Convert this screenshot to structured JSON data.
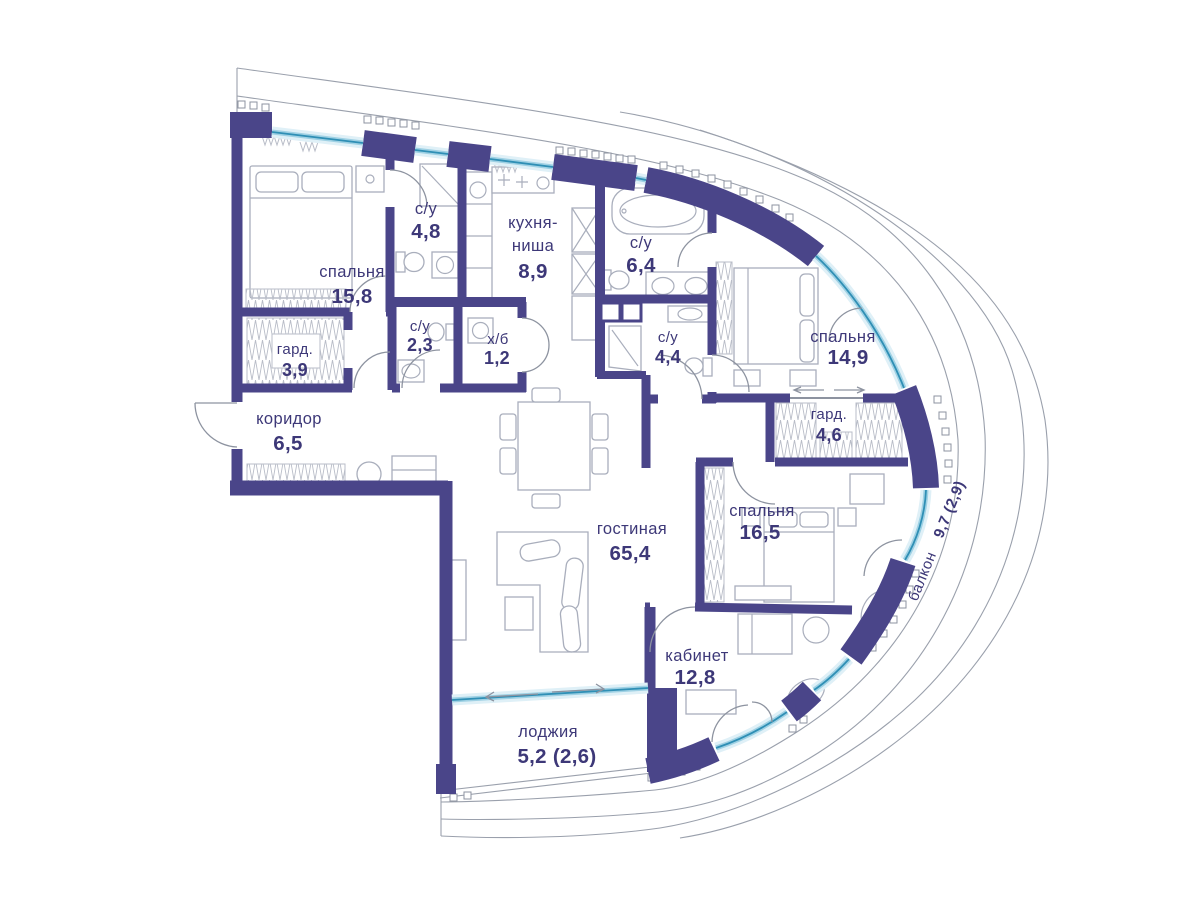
{
  "plan": {
    "type": "apartment-floor-plan",
    "language": "ru",
    "colors": {
      "walls": "#4a4589",
      "windows": "#3a9cc4",
      "labels": "#3d3878",
      "site_outline": "#9aa0ac",
      "furniture": "#a9aebc"
    },
    "rooms": {
      "bedroom1": {
        "name": "спальня",
        "area": "15,8"
      },
      "bath1": {
        "name": "с/у",
        "area": "4,8"
      },
      "kitchen": {
        "name1": "кухня-",
        "name2": "ниша",
        "area": "8,9"
      },
      "bath2": {
        "name": "с/у",
        "area": "6,4"
      },
      "bedroom2": {
        "name": "спальня",
        "area": "14,9"
      },
      "wardrobe1": {
        "name": "гард.",
        "area": "3,9"
      },
      "bath3": {
        "name": "с/у",
        "area": "2,3"
      },
      "utility": {
        "name": "х/б",
        "area": "1,2"
      },
      "bath4": {
        "name": "с/у",
        "area": "4,4"
      },
      "wardrobe2": {
        "name": "гард.",
        "area": "4,6"
      },
      "hallway": {
        "name": "коридор",
        "area": "6,5"
      },
      "living": {
        "name": "гостиная",
        "area": "65,4"
      },
      "bedroom3": {
        "name": "спальня",
        "area": "16,5"
      },
      "study": {
        "name": "кабинет",
        "area": "12,8"
      },
      "loggia": {
        "name": "лоджия",
        "area": "5,2 (2,6)"
      },
      "balcony": {
        "name": "балкон",
        "area": "9,7 (2,9)"
      }
    }
  }
}
